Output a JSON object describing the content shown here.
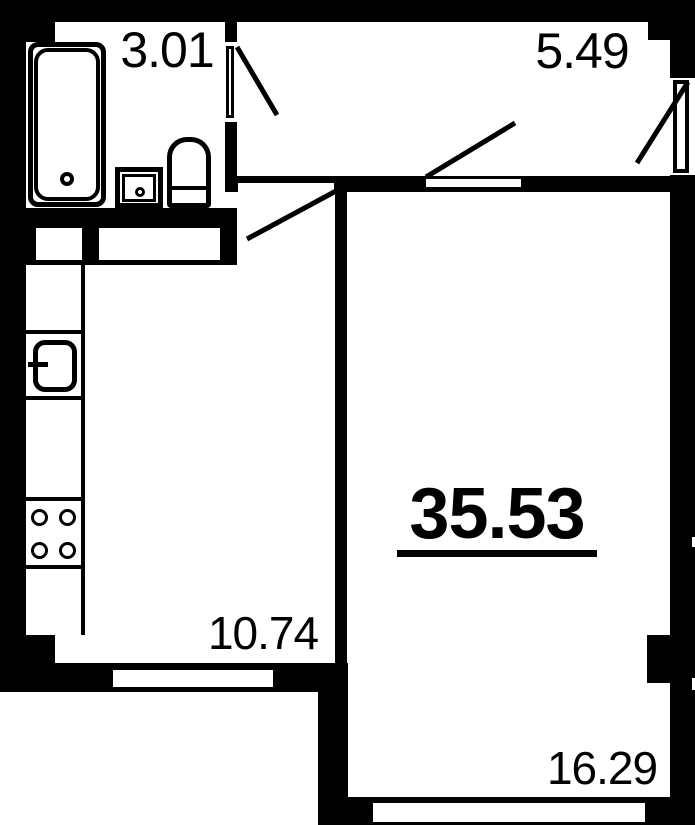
{
  "floorplan": {
    "title": "apartment-floor-plan",
    "total_area": "35.53",
    "rooms": {
      "bathroom": {
        "area": "3.01"
      },
      "hallway": {
        "area": "5.49"
      },
      "kitchen": {
        "area": "10.74"
      },
      "living_room": {
        "area": "16.29"
      }
    },
    "colors": {
      "wall": "#000000",
      "background": "#ffffff",
      "text": "#000000"
    }
  }
}
